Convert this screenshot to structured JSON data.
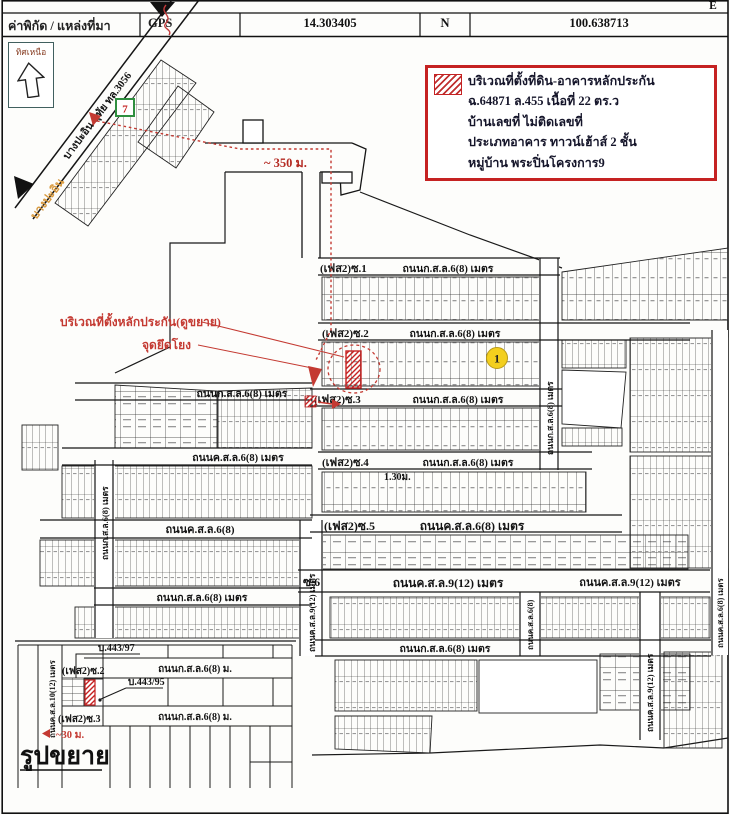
{
  "header": {
    "source_label": "ค่าพิกัด / แหล่งที่มา",
    "gps": "GPS",
    "latitude": "14.303405",
    "lat_hemi": "N",
    "longitude": "100.638713",
    "lon_hemi": "E"
  },
  "compass": {
    "north_label": "ทิศเหนือ"
  },
  "info_box": {
    "lines": [
      "บริเวณที่ตั้งที่ดิน-อาคารหลักประกัน",
      "ฉ.64871 ล.455 เนื้อที่ 22 ตร.ว",
      "บ้านเลขที่ ไม่ติดเลขที่",
      "ประเภทอาคาร ทาวน์เฮ้าส์ 2 ชั้น",
      "หมู่บ้าน พระปิ่นโครงการ9"
    ]
  },
  "highway": {
    "name": "บางปะอิน-อุทัย ทล.3056",
    "area": "บางปะอิน",
    "seven_eleven": "7"
  },
  "red_notes": {
    "site": "บริเวณที่ตั้งหลักประกัน(ดูขยาย)",
    "tie_point": "จุดยึดโยง",
    "dist_350": "~ 350 ม.",
    "dist_30": "~30 ม."
  },
  "markers": {
    "circle_1": "1",
    "width_130": "1.30ม."
  },
  "roads": {
    "soi1": "(เฟส2)ซ.1",
    "soi2": "(เฟส2)ซ.2",
    "soi3": "(เฟส2)ซ.3",
    "soi4": "(เฟส2)ซ.4",
    "soi5": "(เฟส2)ซ.5",
    "soi6": "ซ.6",
    "ksl68": "ถนนก.ส.ล.6(8) เมตร",
    "khsl68": "ถนนค.ส.ล.6(8) เมตร",
    "khsl68_short": "ถนนค.ส.ล.6(8)",
    "khsl912": "ถนนค.ส.ล.9(12) เมตร",
    "ksl68_m": "ถนนก.ส.ล.6(8) ม.",
    "khsl1012": "ถนนค.ส.ล.10(12) เมตร"
  },
  "inset": {
    "title": "รูปขยาย",
    "house_443_97": "บ.443/97",
    "house_443_95": "บ.443/95"
  },
  "colors": {
    "red": "#cc2a2a",
    "yellow": "#f3cf1e",
    "green": "#2f8f3f",
    "orange": "#d89a40"
  }
}
